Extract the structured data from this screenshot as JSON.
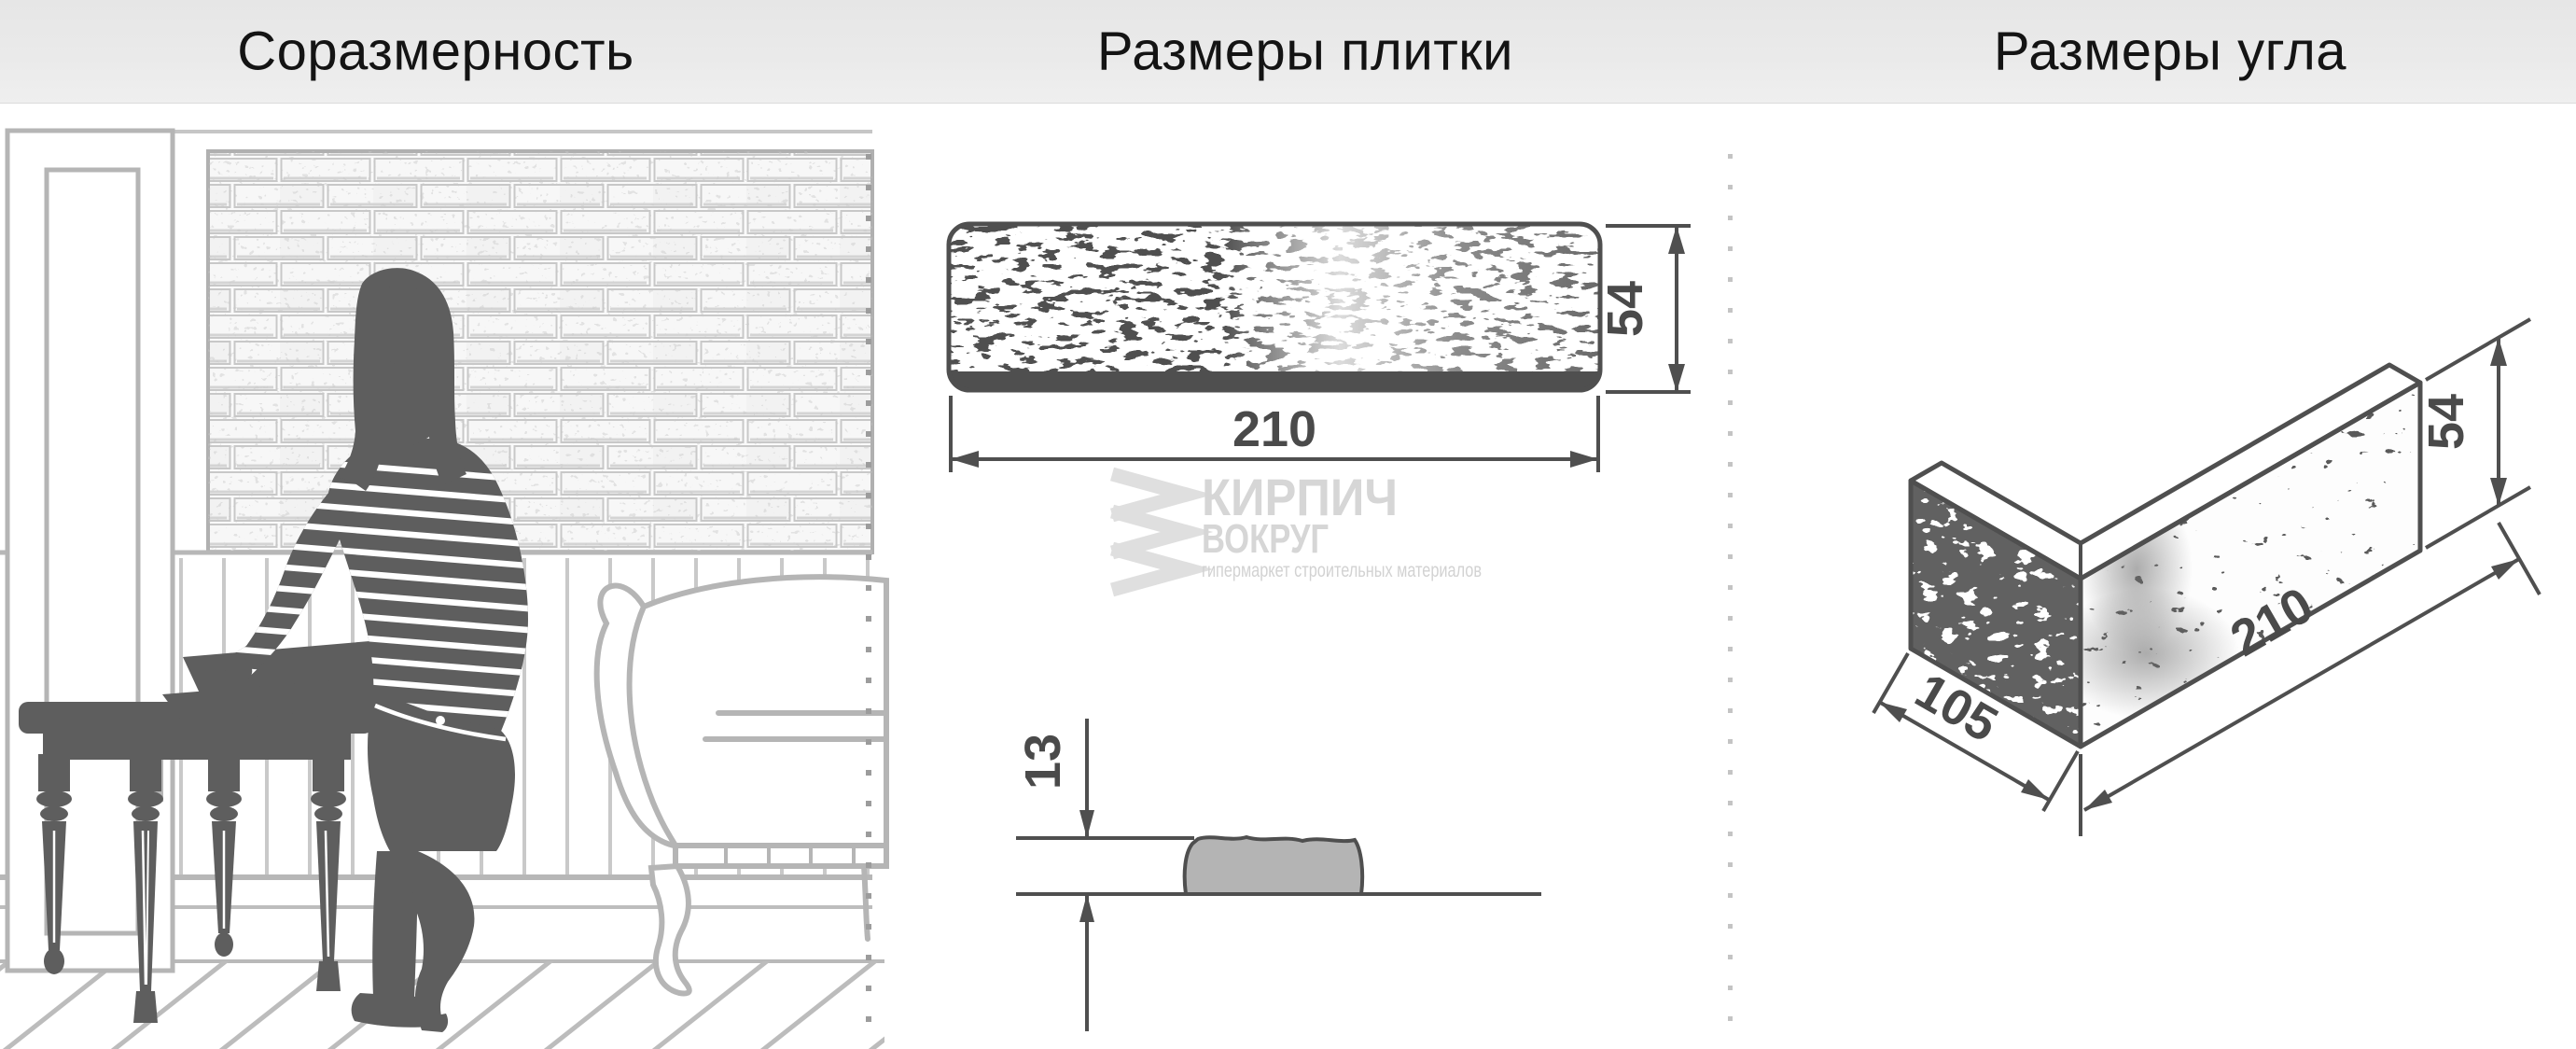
{
  "header": {
    "sections": [
      {
        "label": "Соразмерность"
      },
      {
        "label": "Размеры плитки"
      },
      {
        "label": "Размеры угла"
      }
    ]
  },
  "tile_diagram": {
    "width_mm": "210",
    "height_mm": "54",
    "thickness_mm": "13"
  },
  "corner_diagram": {
    "depth_mm": "105",
    "length_mm": "210",
    "height_mm": "54"
  },
  "watermark": {
    "brand_top": "КИРПИЧ",
    "brand_bottom": "ВОКРУГ",
    "tagline": "гипермаркет строительных материалов"
  },
  "colors": {
    "dimension_line": "#4f4f4f",
    "dimension_text": "#4a4a4a",
    "silhouette": "#5e5e5e",
    "room_line": "#b7b7b7",
    "brick_line": "#c8c8c8",
    "watermark_gray": "#d6d6d6",
    "separator_dots_left": "#9c9c9c",
    "separator_dots_right": "#c4c4c4",
    "profile_fill": "#b4b4b4"
  }
}
